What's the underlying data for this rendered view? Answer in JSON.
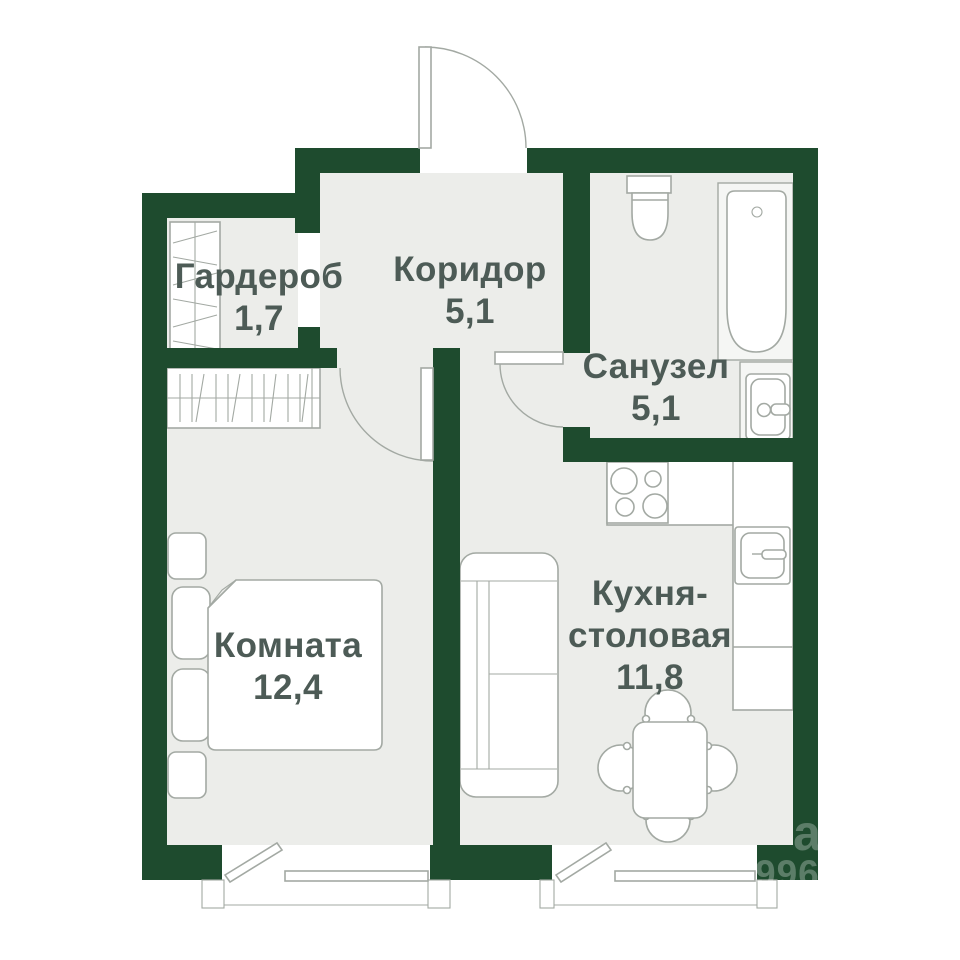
{
  "colors": {
    "wall": "#1E4B2E",
    "floor": "#ECEDEA",
    "light": "#F5F6F4",
    "line": "#A3A9A3",
    "text": "#4D5B56",
    "watermark": "rgba(255,255,255,0.28)"
  },
  "rooms": {
    "wardrobe": {
      "name": "Гардероб",
      "area": "1,7"
    },
    "corridor": {
      "name": "Коридор",
      "area": "5,1"
    },
    "bathroom": {
      "name": "Санузел",
      "area": "5,1"
    },
    "bedroom": {
      "name": "Комната",
      "area": "12,4"
    },
    "kitchen": {
      "name_line1": "Кухня-",
      "name_line2": "столовая",
      "area": "11,8"
    }
  },
  "watermark": {
    "letters": "а",
    "digits": "9966"
  }
}
